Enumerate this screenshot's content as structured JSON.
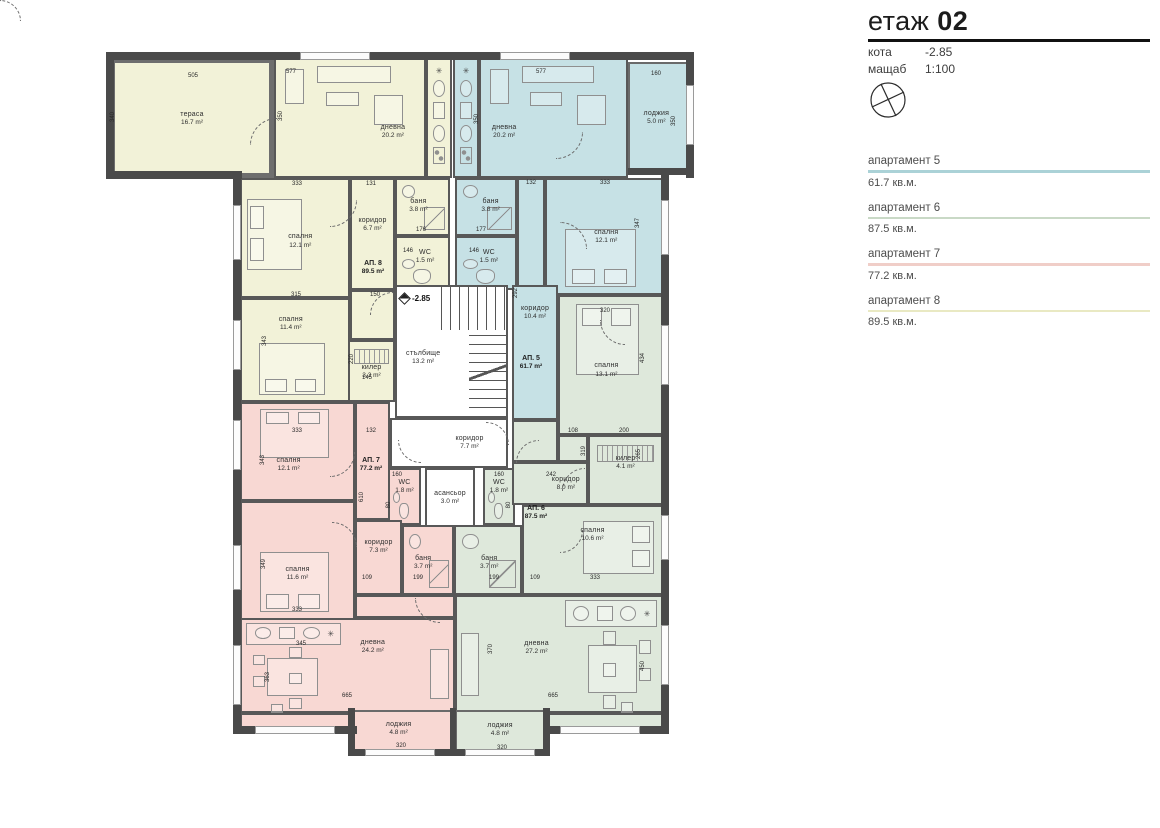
{
  "title_block": {
    "floor_word": "етаж",
    "floor_number": "02",
    "meta": [
      {
        "label": "кота",
        "value": "-2.85"
      },
      {
        "label": "мащаб",
        "value": "1:100"
      }
    ]
  },
  "legend": {
    "items": [
      {
        "name": "апартамент 5",
        "area": "61.7 кв.м.",
        "color": "#abd2d7"
      },
      {
        "name": "апартамент 6",
        "area": "87.5 кв.м.",
        "color": "#c9d9c6"
      },
      {
        "name": "апартамент 7",
        "area": "77.2 кв.м.",
        "color": "#f0cec8"
      },
      {
        "name": "апартамент 8",
        "area": "89.5 кв.м.",
        "color": "#e9e9c3"
      }
    ]
  },
  "icons": {
    "compass": "north-compass-icon",
    "level_marker": "level-mark-icon",
    "kitchen_star": "✳"
  },
  "plan": {
    "level_marker_text": "-2.85",
    "apt_colors": {
      "ap5": "#c6e1e5",
      "ap6": "#dee8db",
      "ap7": "#f8d8d3",
      "ap8": "#f2f2d8",
      "common": "#ffffff"
    },
    "units": [
      {
        "name": "АП. 8",
        "area": "89.5 m²",
        "x": 373,
        "y": 268
      },
      {
        "name": "АП. 5",
        "area": "61.7 m²",
        "x": 531,
        "y": 363
      },
      {
        "name": "АП. 7",
        "area": "77.2 m²",
        "x": 371,
        "y": 465
      },
      {
        "name": "АП. 6",
        "area": "87.5 m²",
        "x": 536,
        "y": 513
      }
    ],
    "rooms": [
      {
        "id": "terasa",
        "apt": "ap8",
        "name": "тераса",
        "area": "16.7 m²",
        "x": 110,
        "y": 58,
        "w": 164,
        "h": 120,
        "type": "terrace",
        "label": [
          50,
          51
        ]
      },
      {
        "id": "dnevna8",
        "apt": "ap8",
        "name": "дневна",
        "area": "20.2 m²",
        "x": 274,
        "y": 58,
        "w": 152,
        "h": 120,
        "type": "living",
        "sofa": "top",
        "label": [
          79,
          62
        ]
      },
      {
        "id": "kitchen8",
        "apt": "ap8",
        "x": 426,
        "y": 58,
        "w": 26,
        "h": 120,
        "type": "kitchen"
      },
      {
        "id": "kitchen5",
        "apt": "ap5",
        "x": 453,
        "y": 58,
        "w": 26,
        "h": 120,
        "type": "kitchen"
      },
      {
        "id": "dnevna5",
        "apt": "ap5",
        "name": "дневна",
        "area": "20.2 m²",
        "x": 479,
        "y": 58,
        "w": 149,
        "h": 120,
        "type": "living",
        "sofa": "top",
        "label": [
          16,
          62
        ]
      },
      {
        "id": "loggia5",
        "apt": "ap5",
        "name": "лоджия",
        "area": "5.0 m²",
        "x": 628,
        "y": 62,
        "w": 60,
        "h": 112,
        "type": "loggia",
        "label": [
          47,
          50
        ]
      },
      {
        "id": "spalnya8a",
        "apt": "ap8",
        "name": "спалня",
        "area": "12.1 m²",
        "x": 240,
        "y": 178,
        "w": 110,
        "h": 120,
        "type": "bed",
        "side": "left",
        "label": [
          55,
          53
        ]
      },
      {
        "id": "koridor8",
        "apt": "ap8",
        "name": "коридор",
        "area": "6.7 m²",
        "x": 350,
        "y": 178,
        "w": 45,
        "h": 112,
        "label": [
          50,
          42
        ]
      },
      {
        "id": "banya8",
        "apt": "ap8",
        "name": "баня",
        "area": "3.8 m²",
        "x": 395,
        "y": 178,
        "w": 55,
        "h": 58,
        "type": "bath",
        "label": [
          42,
          48
        ]
      },
      {
        "id": "wc8",
        "apt": "ap8",
        "name": "WC",
        "area": "1.5 m²",
        "x": 395,
        "y": 236,
        "w": 55,
        "h": 54,
        "type": "wc",
        "label": [
          55,
          38
        ]
      },
      {
        "id": "hall8",
        "apt": "ap8",
        "x": 350,
        "y": 290,
        "w": 45,
        "h": 50
      },
      {
        "id": "kiler8",
        "apt": "ap8",
        "name": "килер",
        "area": "3.3 m²",
        "x": 348,
        "y": 340,
        "w": 47,
        "h": 62,
        "type": "kiler",
        "label": [
          50,
          52
        ]
      },
      {
        "id": "spalnya8b",
        "apt": "ap8",
        "name": "спалня",
        "area": "11.4 m²",
        "x": 240,
        "y": 298,
        "w": 110,
        "h": 104,
        "type": "bed",
        "side": "bottom",
        "label": [
          46,
          24
        ]
      },
      {
        "id": "banya5",
        "apt": "ap5",
        "name": "баня",
        "area": "3.8 m²",
        "x": 455,
        "y": 178,
        "w": 62,
        "h": 58,
        "type": "bath",
        "label": [
          58,
          48
        ]
      },
      {
        "id": "wc5",
        "apt": "ap5",
        "name": "WC",
        "area": "1.5 m²",
        "x": 455,
        "y": 236,
        "w": 62,
        "h": 54,
        "type": "wc",
        "label": [
          55,
          38
        ]
      },
      {
        "id": "hall5",
        "apt": "ap5",
        "x": 517,
        "y": 178,
        "w": 28,
        "h": 112
      },
      {
        "id": "spalnya5",
        "apt": "ap5",
        "name": "спалня",
        "area": "12.1 m²",
        "x": 545,
        "y": 178,
        "w": 118,
        "h": 117,
        "type": "bed",
        "side": "bottom",
        "label": [
          52,
          50
        ]
      },
      {
        "id": "koridor5",
        "apt": "ap5",
        "name": "коридор",
        "area": "10.4 m²",
        "x": 512,
        "y": 285,
        "w": 46,
        "h": 135,
        "label": [
          50,
          20
        ]
      },
      {
        "id": "stairs",
        "apt": "common",
        "name": "стълбище",
        "area": "13.2 m²",
        "x": 395,
        "y": 285,
        "w": 113,
        "h": 133,
        "type": "stairs",
        "label": [
          24,
          55
        ]
      },
      {
        "id": "koridor77",
        "apt": "common",
        "name": "коридор",
        "area": "7.7 m²",
        "x": 390,
        "y": 418,
        "w": 118,
        "h": 50,
        "label": [
          68,
          50
        ]
      },
      {
        "id": "lift",
        "apt": "common",
        "name": "асансьор",
        "area": "3.0 m²",
        "x": 425,
        "y": 468,
        "w": 50,
        "h": 60,
        "type": "lift",
        "label": [
          50,
          50
        ]
      },
      {
        "id": "hall7",
        "apt": "ap7",
        "x": 355,
        "y": 402,
        "w": 35,
        "h": 118
      },
      {
        "id": "wc7",
        "apt": "ap7",
        "name": "WC",
        "area": "1.8 m²",
        "x": 388,
        "y": 468,
        "w": 33,
        "h": 57,
        "type": "wc",
        "label": [
          50,
          32
        ]
      },
      {
        "id": "spalnya7a",
        "apt": "ap7",
        "name": "спалня",
        "area": "12.1 m²",
        "x": 240,
        "y": 402,
        "w": 115,
        "h": 99,
        "type": "bed",
        "side": "top",
        "label": [
          42,
          64
        ]
      },
      {
        "id": "spalnya7b",
        "apt": "ap7",
        "name": "спалня",
        "area": "11.6 m²",
        "x": 240,
        "y": 501,
        "w": 115,
        "h": 119,
        "type": "bed",
        "side": "bottom",
        "label": [
          50,
          62
        ]
      },
      {
        "id": "koridor7",
        "apt": "ap7",
        "name": "коридор",
        "area": "7.3 m²",
        "x": 355,
        "y": 520,
        "w": 47,
        "h": 75,
        "label": [
          50,
          35
        ]
      },
      {
        "id": "banya7",
        "apt": "ap7",
        "name": "баня",
        "area": "3.7 m²",
        "x": 402,
        "y": 525,
        "w": 52,
        "h": 70,
        "type": "bath",
        "label": [
          40,
          55
        ]
      },
      {
        "id": "f7b",
        "apt": "ap7",
        "x": 355,
        "y": 595,
        "w": 100,
        "h": 23
      },
      {
        "id": "dnevna7",
        "apt": "ap7",
        "name": "дневна",
        "area": "24.2 m²",
        "x": 240,
        "y": 618,
        "w": 215,
        "h": 95,
        "type": "livingbig",
        "kitchen": "tl",
        "dining": "left",
        "sofa": "right",
        "label": [
          62,
          30
        ]
      },
      {
        "id": "f7c",
        "apt": "ap7",
        "x": 240,
        "y": 713,
        "w": 112,
        "h": 17
      },
      {
        "id": "loggia7",
        "apt": "ap7",
        "name": "лоджия",
        "area": "4.8 m²",
        "x": 352,
        "y": 710,
        "w": 103,
        "h": 44,
        "type": "loggia",
        "label": [
          45,
          42
        ]
      },
      {
        "id": "wc6",
        "apt": "ap6",
        "name": "WC",
        "area": "1.8 m²",
        "x": 483,
        "y": 468,
        "w": 32,
        "h": 57,
        "type": "wc",
        "label": [
          50,
          32
        ]
      },
      {
        "id": "banya6",
        "apt": "ap6",
        "name": "баня",
        "area": "3.7 m²",
        "x": 454,
        "y": 525,
        "w": 68,
        "h": 70,
        "type": "bath",
        "label": [
          52,
          55
        ]
      },
      {
        "id": "f6",
        "apt": "ap6",
        "x": 512,
        "y": 420,
        "w": 46,
        "h": 42
      },
      {
        "id": "f6b",
        "apt": "ap6",
        "x": 558,
        "y": 435,
        "w": 30,
        "h": 27
      },
      {
        "id": "koridor6",
        "apt": "ap6",
        "name": "коридор",
        "area": "8.0 m²",
        "x": 512,
        "y": 462,
        "w": 76,
        "h": 43,
        "label": [
          72,
          50
        ]
      },
      {
        "id": "spalnya6a",
        "apt": "ap6",
        "name": "спалня",
        "area": "13.1 m²",
        "x": 558,
        "y": 295,
        "w": 105,
        "h": 140,
        "type": "bed",
        "side": "top",
        "label": [
          46,
          54
        ]
      },
      {
        "id": "kiler6",
        "apt": "ap6",
        "name": "килер",
        "area": "4.1 m²",
        "x": 588,
        "y": 435,
        "w": 75,
        "h": 70,
        "type": "kiler",
        "label": [
          50,
          40
        ]
      },
      {
        "id": "spalnya6b",
        "apt": "ap6",
        "name": "спалня",
        "area": "10.6 m²",
        "x": 522,
        "y": 505,
        "w": 141,
        "h": 90,
        "type": "bed",
        "side": "right",
        "label": [
          50,
          32
        ]
      },
      {
        "id": "dnevna6",
        "apt": "ap6",
        "name": "дневна",
        "area": "27.2 m²",
        "x": 455,
        "y": 595,
        "w": 208,
        "h": 118,
        "type": "livingbig",
        "kitchen": "tr",
        "dining": "right",
        "sofa": "left",
        "label": [
          39,
          45
        ]
      },
      {
        "id": "f6d",
        "apt": "ap6",
        "x": 545,
        "y": 713,
        "w": 118,
        "h": 17
      },
      {
        "id": "loggia6",
        "apt": "ap6",
        "name": "лоджия",
        "area": "4.8 m²",
        "x": 455,
        "y": 710,
        "w": 90,
        "h": 44,
        "type": "loggia",
        "label": [
          50,
          45
        ]
      }
    ],
    "dims": [
      [
        "505",
        193,
        76,
        0
      ],
      [
        "340",
        113,
        117,
        1
      ],
      [
        "577",
        291,
        72,
        0
      ],
      [
        "350",
        281,
        116,
        1
      ],
      [
        "577",
        541,
        72,
        0
      ],
      [
        "350",
        477,
        119,
        1
      ],
      [
        "160",
        656,
        74,
        0
      ],
      [
        "350",
        674,
        121,
        1
      ],
      [
        "333",
        297,
        184,
        0
      ],
      [
        "131",
        371,
        184,
        0
      ],
      [
        "132",
        531,
        183,
        0
      ],
      [
        "333",
        605,
        183,
        0
      ],
      [
        "347",
        638,
        223,
        1
      ],
      [
        "315",
        296,
        295,
        0
      ],
      [
        "150",
        375,
        295,
        0
      ],
      [
        "343",
        265,
        341,
        1
      ],
      [
        "220",
        352,
        359,
        1
      ],
      [
        "145",
        367,
        378,
        0
      ],
      [
        "176",
        421,
        230,
        0
      ],
      [
        "177",
        481,
        230,
        0
      ],
      [
        "146",
        408,
        251,
        0
      ],
      [
        "146",
        474,
        251,
        0
      ],
      [
        "292",
        516,
        293,
        1
      ],
      [
        "320",
        605,
        311,
        0
      ],
      [
        "434",
        643,
        358,
        1
      ],
      [
        "333",
        297,
        431,
        0
      ],
      [
        "132",
        371,
        431,
        0
      ],
      [
        "343",
        263,
        460,
        1
      ],
      [
        "610",
        362,
        497,
        1
      ],
      [
        "349",
        264,
        564,
        1
      ],
      [
        "333",
        297,
        610,
        0
      ],
      [
        "108",
        573,
        431,
        0
      ],
      [
        "200",
        624,
        431,
        0
      ],
      [
        "319",
        584,
        451,
        1
      ],
      [
        "265",
        639,
        454,
        1
      ],
      [
        "242",
        551,
        475,
        0
      ],
      [
        "160",
        397,
        475,
        0
      ],
      [
        "160",
        499,
        475,
        0
      ],
      [
        "80",
        389,
        505,
        1
      ],
      [
        "80",
        509,
        505,
        1
      ],
      [
        "199",
        418,
        578,
        0
      ],
      [
        "109",
        367,
        578,
        0
      ],
      [
        "199",
        494,
        578,
        0
      ],
      [
        "109",
        535,
        578,
        0
      ],
      [
        "333",
        595,
        578,
        0
      ],
      [
        "345",
        301,
        644,
        0
      ],
      [
        "363",
        268,
        677,
        1
      ],
      [
        "665",
        347,
        696,
        0
      ],
      [
        "320",
        401,
        746,
        0
      ],
      [
        "665",
        553,
        696,
        0
      ],
      [
        "320",
        502,
        748,
        0
      ],
      [
        "370",
        491,
        649,
        1
      ],
      [
        "450",
        643,
        666,
        1
      ]
    ]
  }
}
